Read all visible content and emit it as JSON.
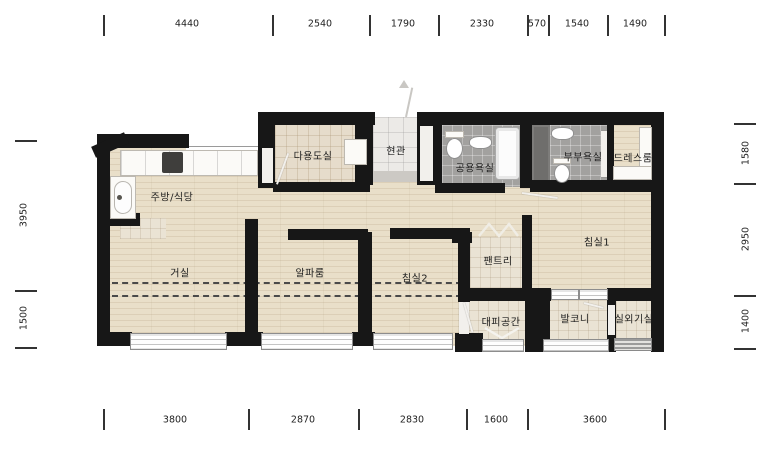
{
  "plan": {
    "rooms": {
      "kitchen_dining": "주방/식당",
      "living_room": "거실",
      "alpha_room": "알파룸",
      "bedroom2": "침실2",
      "pantry": "팬트리",
      "bedroom1": "침실1",
      "utility_room": "다용도실",
      "entrance": "현관",
      "common_bathroom": "공용욕실",
      "master_bathroom": "부부욕실",
      "dress_room": "드레스룸",
      "evacuation_space": "대피공간",
      "balcony": "발코니",
      "outdoor_unit_room": "실외기실"
    },
    "dimensions_mm": {
      "top": [
        "4440",
        "2540",
        "1790",
        "2330",
        "570",
        "1540",
        "1490"
      ],
      "bottom": [
        "3800",
        "2870",
        "2830",
        "1600",
        "3600"
      ],
      "left": [
        "3950",
        "1500"
      ],
      "right": [
        "1580",
        "2950",
        "1400"
      ]
    },
    "colors": {
      "wall": "#171717",
      "wood_floor": "#e9dfc9",
      "beige_tile": "#e6dccb",
      "gray_tile": "#a2a19f",
      "entry_tile": "#eceae7",
      "shaft": "#6f6e6c"
    }
  }
}
